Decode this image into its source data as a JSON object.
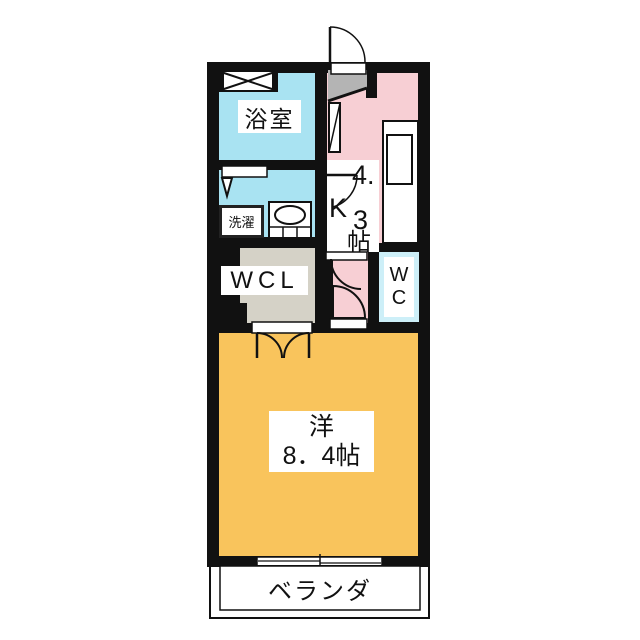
{
  "floorplan": {
    "bathroom_label": "浴室",
    "laundry_label": "洗濯",
    "kitchen_label": {
      "p1": "4.",
      "p2": "K",
      "p3": "3",
      "p4": "帖"
    },
    "wcl_label": "WCL",
    "wc_label": {
      "line1": "W",
      "line2": "C"
    },
    "main_room_label": {
      "line1": "洋",
      "line2": "8．4帖"
    },
    "veranda_label": "ベランダ",
    "colors": {
      "wall": "#111111",
      "bathroom_washroom": "#a9e3f2",
      "kitchen_corridor": "#f7cfd4",
      "wc": "#cdeff8",
      "main_room": "#f9c45c",
      "entry_gray": "#b4b4b4",
      "closet_gray": "#d5d2c7"
    }
  }
}
